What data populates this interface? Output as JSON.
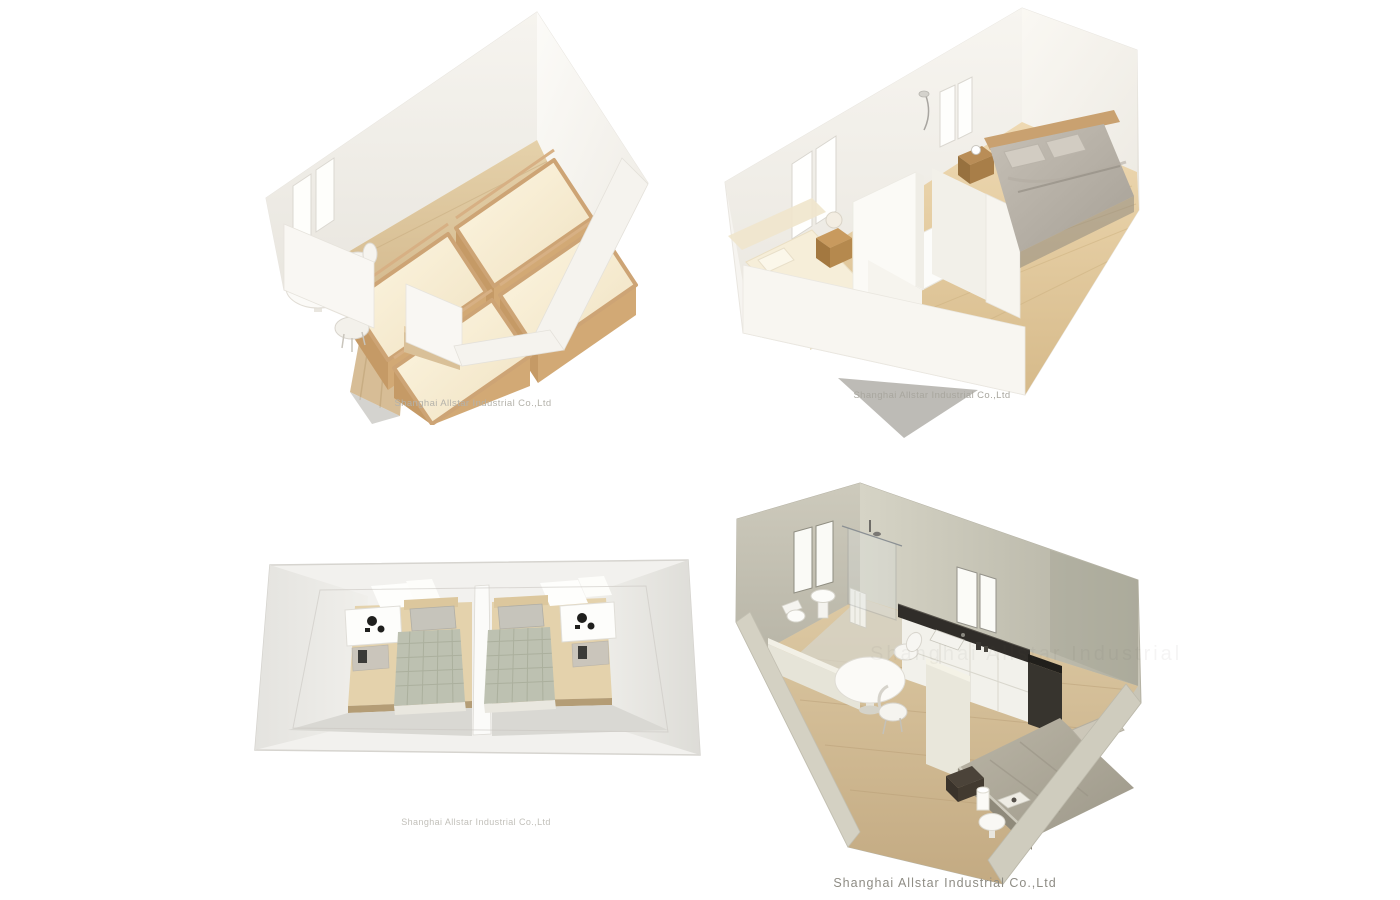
{
  "page": {
    "background": "#ffffff",
    "company_watermark": "Shanghai Allstar Industrial Co.,Ltd"
  },
  "panels": [
    {
      "id": "bunk-bed-dormitory-render",
      "caption": "Shanghai Allstar Industrial Co.,Ltd"
    },
    {
      "id": "two-bedroom-unit-with-central-bathroom-render",
      "caption": "Shanghai Allstar Industrial Co.,Ltd"
    },
    {
      "id": "twin-guest-rooms-top-view-render",
      "caption": "Shanghai Allstar Industrial Co.,Ltd"
    },
    {
      "id": "studio-unit-kitchen-bathroom-render",
      "caption": "Shanghai Allstar Industrial Co.,Ltd",
      "ghost_watermark": "Shanghai Allstar Industrial Co.,Ltd"
    }
  ],
  "colors": {
    "wall_white": "#f6f4f0",
    "wall_shadow": "#e9e6df",
    "wood_floor": "#dcc49c",
    "pine_bed_frame": "#cfa877",
    "mattress_cream": "#f9efdb",
    "gray_bed": "#b9b3a9",
    "sage_wall": "#c6c4b6",
    "dark_countertop": "#2f2c28",
    "checkered_blanket": "#bdc1b1",
    "caption_gray": "#a8a69e"
  }
}
